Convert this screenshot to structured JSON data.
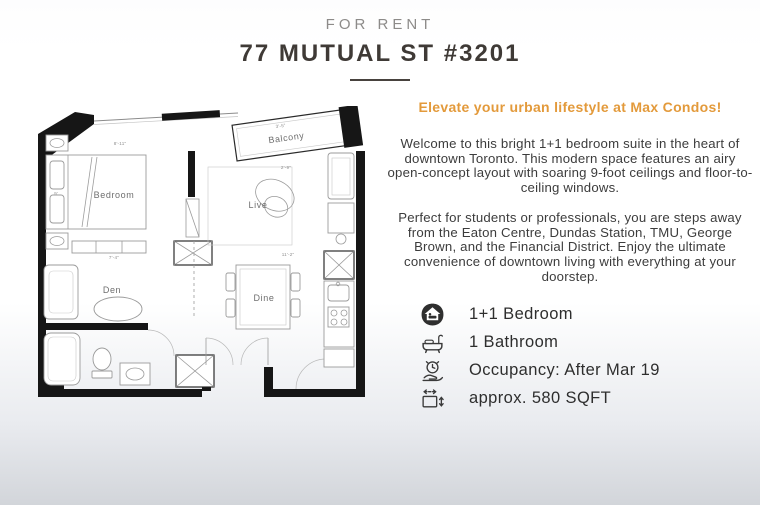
{
  "colors": {
    "accent_orange": "#e39a3b",
    "title_dark": "#3f3a36",
    "body_text": "#3c3c3c",
    "wall_black": "#161616",
    "bg_bottom": "#d2d5da"
  },
  "header": {
    "label": "FOR RENT",
    "title": "77 MUTUAL ST #3201"
  },
  "listing": {
    "headline": "Elevate your urban lifestyle at Max Condos!",
    "paragraph1": "Welcome to this bright 1+1 bedroom suite in the heart of downtown Toronto. This modern space features an airy open-concept layout with soaring 9-foot ceilings and floor-to-ceiling windows.",
    "paragraph2": "Perfect for students or professionals, you are steps away from the Eaton Centre, Dundas Station, TMU, George Brown, and the Financial District. Enjoy the ultimate convenience of downtown living with everything at your doorstep.",
    "features": [
      {
        "icon": "bedroom-icon",
        "label": "1+1 Bedroom"
      },
      {
        "icon": "bathroom-icon",
        "label": "1 Bathroom"
      },
      {
        "icon": "occupancy-icon",
        "label": "Occupancy: After Mar 19"
      },
      {
        "icon": "sqft-icon",
        "label": "approx. 580 SQFT"
      }
    ]
  },
  "floorplan": {
    "rooms": {
      "bedroom": "Bedroom",
      "balcony": "Balcony",
      "live": "Live",
      "den": "Den",
      "dine": "Dine"
    },
    "dims": {
      "bedroom_w": "8'-11\"",
      "bedroom_h": "9'",
      "live_w": "2'-9\"",
      "den_w": "7'-4\"",
      "dine_w": "11'-2\"",
      "balcony_w": "3'-5\""
    }
  }
}
